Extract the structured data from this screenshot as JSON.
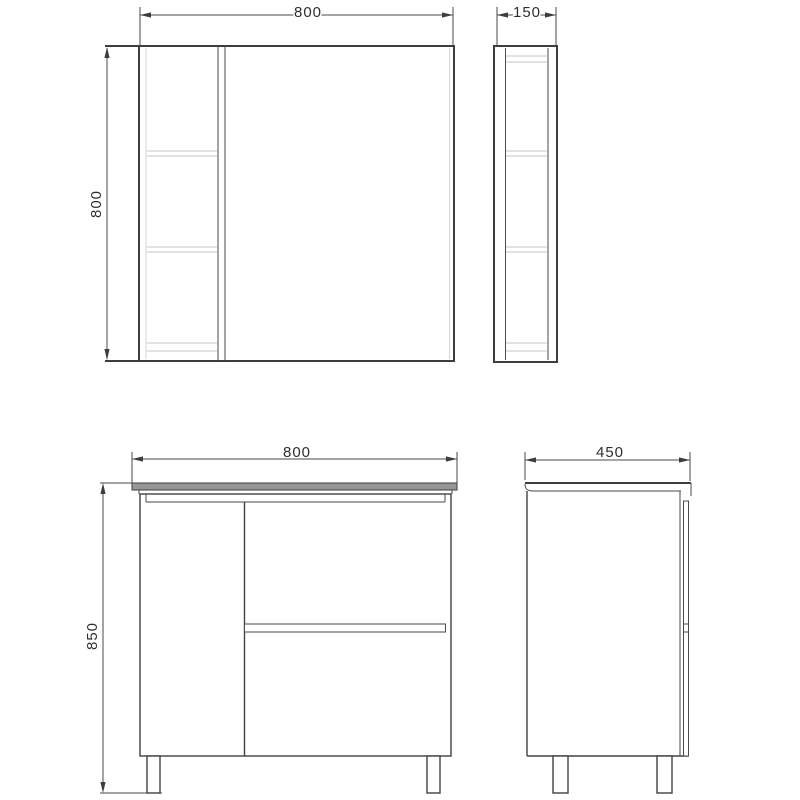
{
  "drawing": {
    "type": "technical-orthographic-views",
    "subject": "bathroom furniture set: mirror cabinet (top views) and floor vanity unit (bottom views)",
    "dims": {
      "mirror_front_width": "800",
      "mirror_front_height": "800",
      "mirror_side_depth": "150",
      "vanity_front_width": "800",
      "vanity_front_height": "850",
      "vanity_side_depth": "450"
    },
    "colors": {
      "line": "#3d3d3d",
      "shelf_line": "#c5c5c5",
      "countertop_fill": "#969696",
      "background": "#ffffff"
    }
  }
}
